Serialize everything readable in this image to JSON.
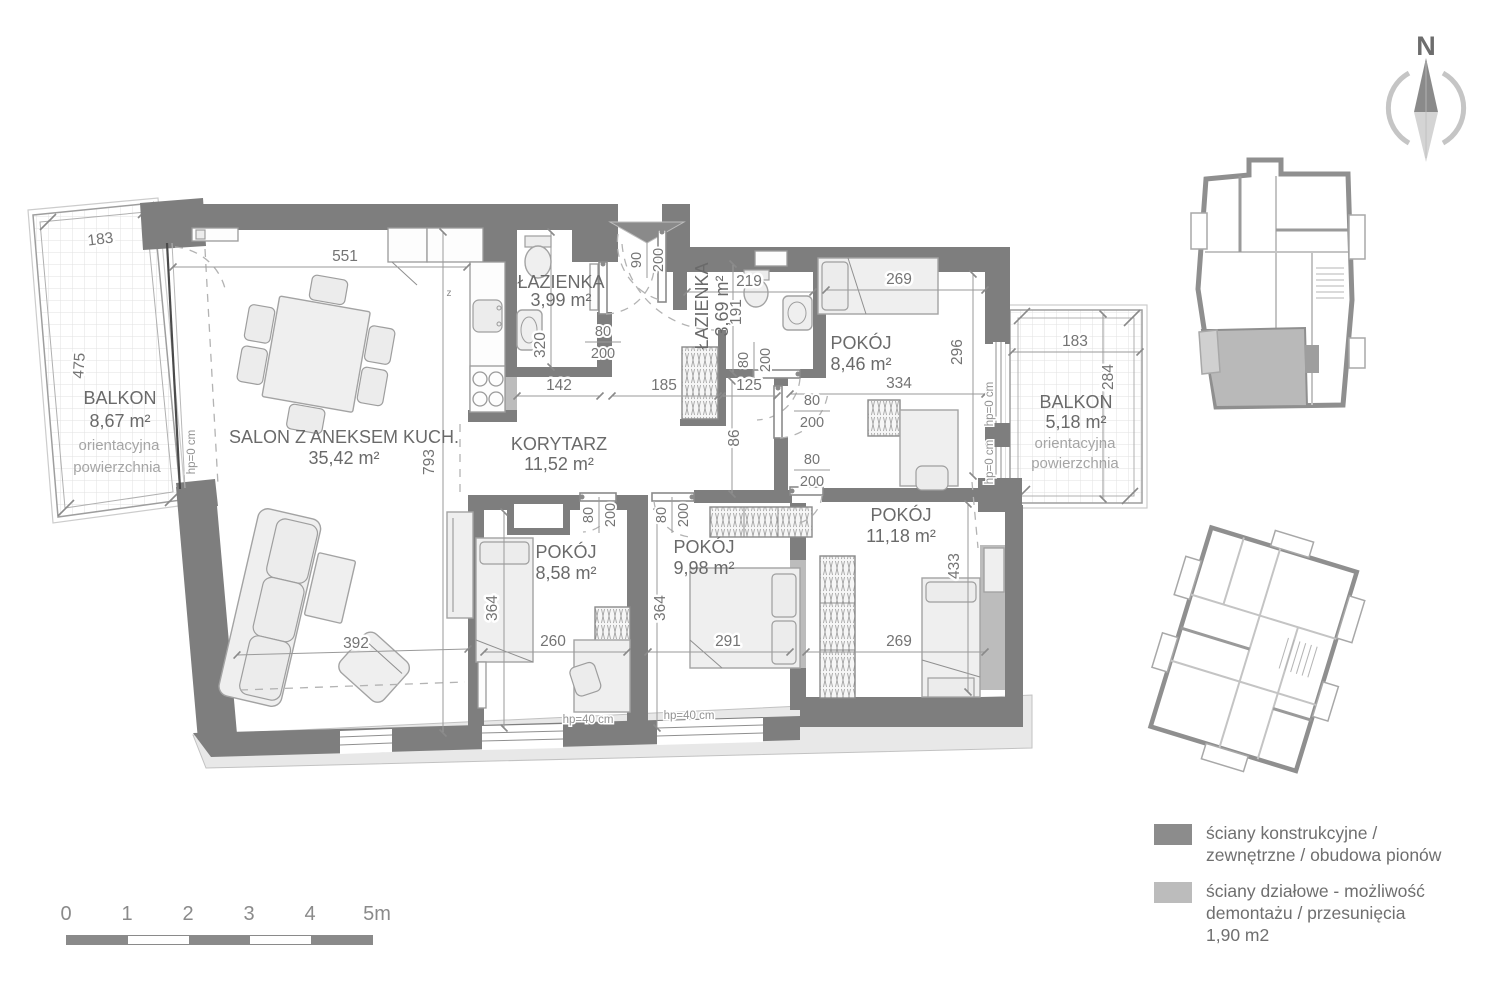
{
  "compass": {
    "label": "N"
  },
  "plan": {
    "rooms": {
      "balkon_l": {
        "name": "BALKON",
        "area": "8,67 m²"
      },
      "salon": {
        "name": "SALON Z ANEKSEM KUCH.",
        "area": "35,42 m²"
      },
      "lazienka_1": {
        "name": "ŁAZIENKA",
        "area": "3,99 m²"
      },
      "korytarz": {
        "name": "KORYTARZ",
        "area": "11,52 m²"
      },
      "lazienka_2": {
        "name": "ŁAZIENKA",
        "area": "3,69 m²"
      },
      "pokoj_846": {
        "name": "POKÓJ",
        "area": "8,46 m²"
      },
      "pokoj_1118": {
        "name": "POKÓJ",
        "area": "11,18 m²"
      },
      "pokoj_858": {
        "name": "POKÓJ",
        "area": "8,58 m²"
      },
      "pokoj_998": {
        "name": "POKÓJ",
        "area": "9,98 m²"
      },
      "balkon_r": {
        "name": "BALKON",
        "area": "5,18 m²"
      }
    },
    "balcony_note": {
      "line1": "orientacyjna",
      "line2": "powierzchnia"
    },
    "dims": {
      "w183_left": "183",
      "w551": "551",
      "h475": "475",
      "h793": "793",
      "h320": "320",
      "w142": "142",
      "w185": "185",
      "w125": "125",
      "h86": "86",
      "w219": "219",
      "h191": "191",
      "w269_top": "269",
      "w334": "334",
      "h296": "296",
      "w183_right": "183",
      "h284": "284",
      "h433": "433",
      "w269_bottom": "269",
      "w291": "291",
      "w260": "260",
      "w392": "392",
      "h364_a": "364",
      "h364_b": "364"
    },
    "door_labels": {
      "entrance_width": "90",
      "door_width": "80",
      "door_height": "200"
    },
    "sill_labels": {
      "hp_0": "hp=0 cm",
      "hp_40": "hp=40 cm"
    },
    "appliance_label": "z"
  },
  "colors": {
    "wall_structural": "#7e7e7e",
    "wall_partition": "#bcbcbc"
  },
  "legend": {
    "items": [
      {
        "swatch": "#8c8c8c",
        "line1": "ściany konstrukcyjne /",
        "line2": "zewnętrzne / obudowa pionów"
      },
      {
        "swatch": "#bcbcbc",
        "line1": "ściany działowe - możliwość",
        "line2": "demontażu / przesunięcia",
        "line3": "1,90 m2"
      }
    ]
  },
  "scale_bar": {
    "ticks": [
      "0",
      "1",
      "2",
      "3",
      "4",
      "5m"
    ]
  }
}
